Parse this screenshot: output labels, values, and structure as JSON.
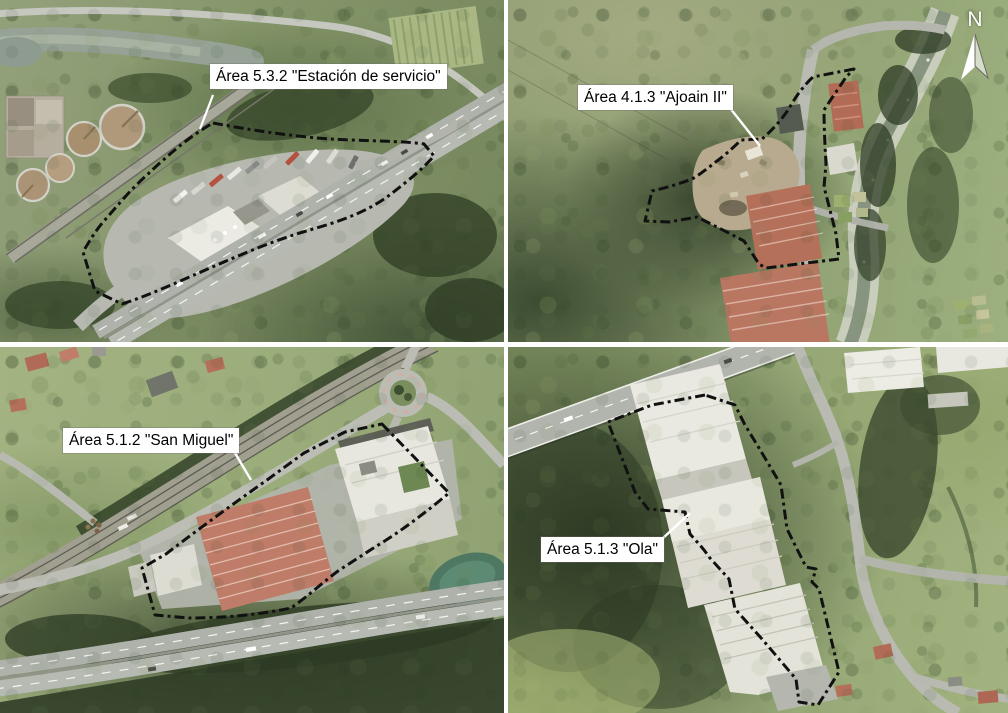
{
  "figure": {
    "type": "aerial-orthophoto-montage",
    "panels": [
      {
        "id": "estacion-de-servicio",
        "label": "Área 5.3.2 \"Estación de servicio\""
      },
      {
        "id": "ajoain-ii",
        "label": "Área 4.1.3 \"Ajoain II\""
      },
      {
        "id": "san-miguel",
        "label": "Área 5.1.2 \"San Miguel\""
      },
      {
        "id": "ola",
        "label": "Área 5.1.3 \"Ola\""
      }
    ],
    "north_arrow": {
      "label": "N"
    },
    "style": {
      "boundary_color": "#111111",
      "boundary_style": "dash-dot",
      "label_bg": "#ffffff",
      "label_text_color": "#000000",
      "leader_color": "#ffffff",
      "north_color": "#ffffff"
    }
  }
}
